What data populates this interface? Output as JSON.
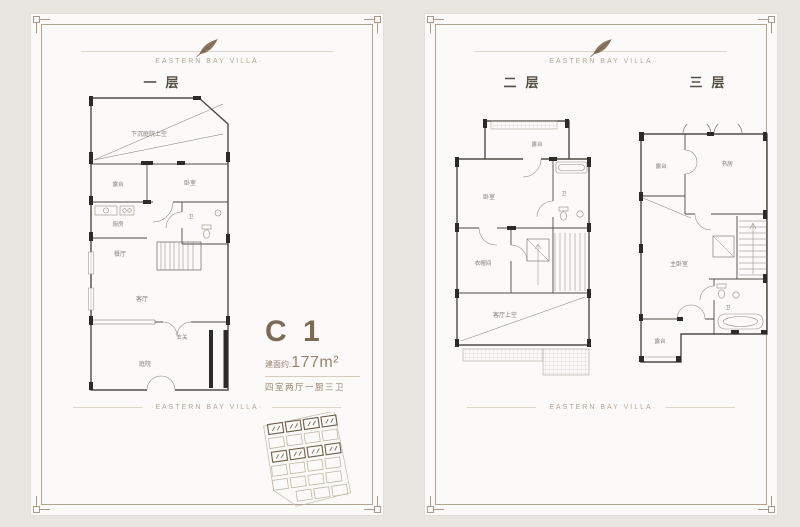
{
  "brand_tagline": "·EASTERN BAY VILLA·",
  "unit": {
    "name": "C 1",
    "area_label": "建面约:",
    "area_value": "177m²",
    "config": "四室两厅一厨三卫"
  },
  "floors": {
    "f1": {
      "title": "一层",
      "rooms": {
        "void": "下沉庭院上空",
        "terrace": "露台",
        "bedroom": "卧室",
        "kitchen": "厨房",
        "bath": "卫",
        "dining": "餐厅",
        "living": "客厅",
        "foyer": "玄关",
        "courtyard": "庭院"
      }
    },
    "f2": {
      "title": "二层",
      "rooms": {
        "terrace": "露台",
        "bedroom": "卧室",
        "bath": "卫",
        "cloakroom": "衣帽间",
        "living_void": "客厅上空"
      }
    },
    "f3": {
      "title": "三层",
      "rooms": {
        "terrace_top": "露台",
        "study": "书房",
        "master": "主卧室",
        "bath": "卫",
        "terrace_bottom": "露台"
      }
    }
  },
  "colors": {
    "accent_brown": "#8d7862",
    "wall": "#4f4a45",
    "frame": "#b3a492"
  }
}
